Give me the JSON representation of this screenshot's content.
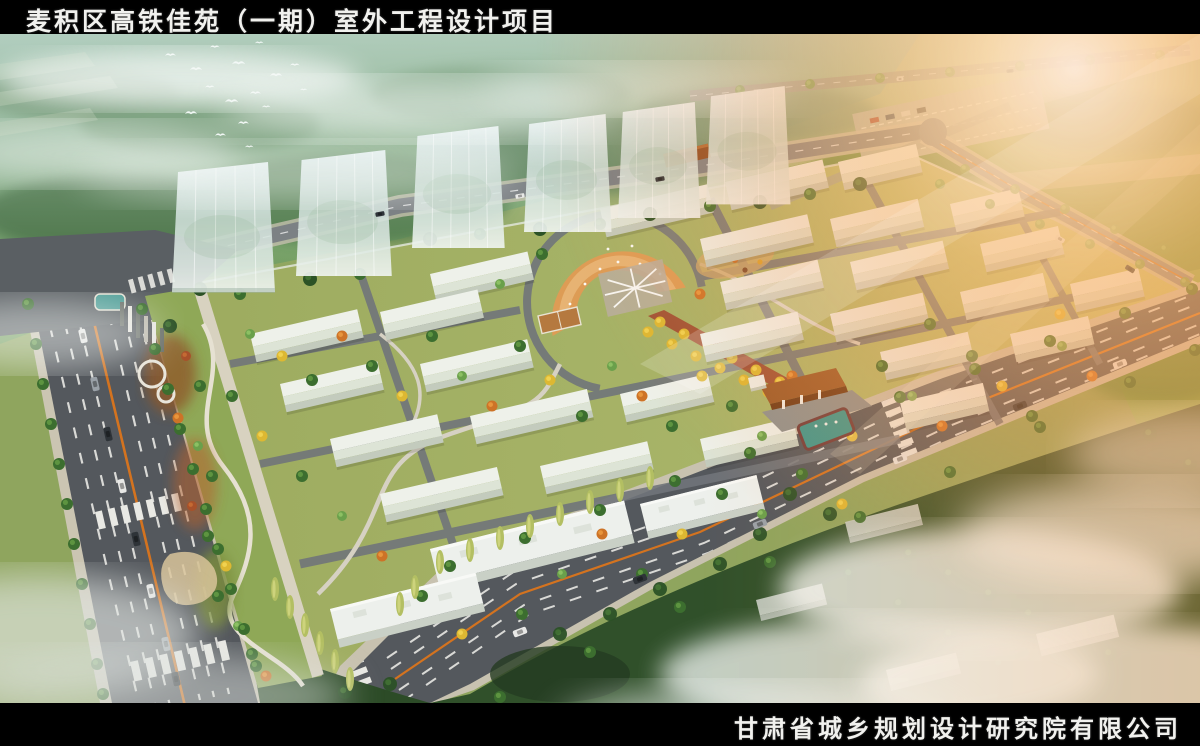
{
  "title_bar": {
    "title": "麦积区高铁佳苑（一期）室外工程设计项目"
  },
  "footer": {
    "company": "甘肃省城乡规划设计研究院有限公司"
  },
  "scene": {
    "type": "aerial architectural rendering",
    "elements": [
      "residential towers",
      "low-rise building rows",
      "central plaza",
      "entrance gate",
      "urban roads with traffic",
      "landscaped park",
      "forest with mist",
      "sun glare",
      "flying birds"
    ]
  },
  "palette": {
    "bar_background": "#000000",
    "bar_text": "#f1f1ee",
    "asphalt": "#55595e",
    "sidewalk": "#cbc5b2",
    "site_green": "#a4b469",
    "hill_green": "#6f9b6a",
    "forest_dark": "#2f4f2b",
    "roof_light": "#e9ede6",
    "tower_glass": "#dce9ed",
    "plaza_orange": "#dd9c55",
    "axis_red": "#a04a31",
    "gate_brown": "#96521f",
    "pool_teal": "#3e948d",
    "lane_orange": "#d4731f",
    "sun_glow": "#ffc27d"
  }
}
